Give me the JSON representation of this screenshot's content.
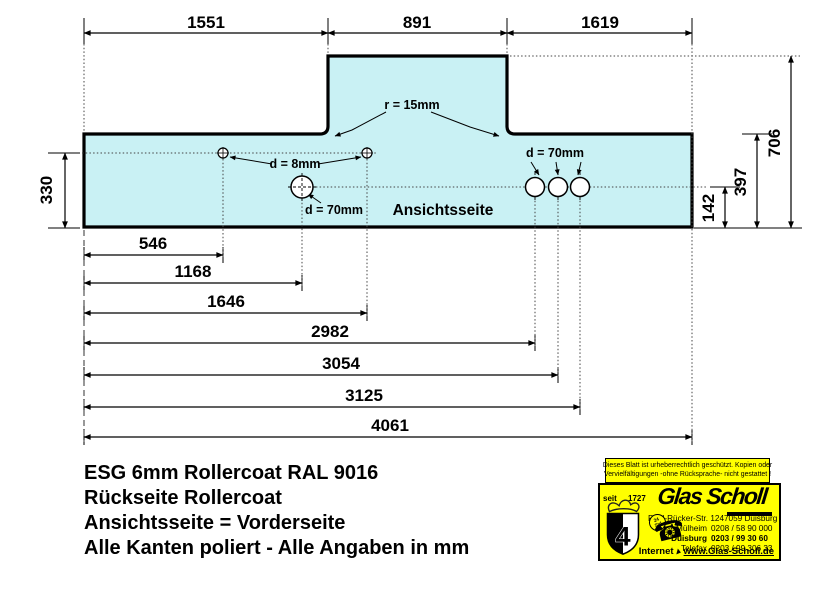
{
  "drawing": {
    "dims_top": [
      "1551",
      "891",
      "1619"
    ],
    "dim_left": "330",
    "dims_right": {
      "total": "706",
      "mid": "397",
      "low": "142"
    },
    "dims_bottom": [
      "546",
      "1168",
      "1646",
      "2982",
      "3054",
      "3125",
      "4061"
    ],
    "notes": {
      "radius": "r = 15mm",
      "small_holes": "d = 8mm",
      "large_hole_left": "d = 70mm",
      "large_holes_right": "d = 70mm",
      "face": "Ansichtsseite"
    }
  },
  "title_block": {
    "line1": "ESG 6mm Rollercoat RAL 9016",
    "line2": "Rückseite Rollercoat",
    "line3": "Ansichtsseite = Vorderseite",
    "line4": "Alle Kanten poliert - Alle Angaben in mm"
  },
  "stamp": {
    "copyright_line1": "Dieses Blatt ist urheberrechtlich geschützt. Kopien oder",
    "copyright_line2": "Vervielfältigungen -ohne Rücksprache- nicht gestattet !",
    "since": "seit",
    "year": "1727",
    "company": "Glas Scholl",
    "street": "Paul-Rücker-Str. 12",
    "city": "47059 Duisburg",
    "phones": [
      {
        "place": "Mülheim",
        "number": "0208 / 58 90 000"
      },
      {
        "place": "Duisburg",
        "number": "0203 / 99 30 60"
      },
      {
        "place": "Telefax",
        "number": "0203 / 99 306 33"
      }
    ],
    "internet_label": "Internet",
    "internet_url": "www.Glas-Scholl.de",
    "badge_top": "24",
    "badge_bottom": "Std",
    "crest_number": "4"
  },
  "colors": {
    "glass_fill": "#c9f1f4",
    "stamp_bg": "#ffff00",
    "line": "#000000"
  }
}
